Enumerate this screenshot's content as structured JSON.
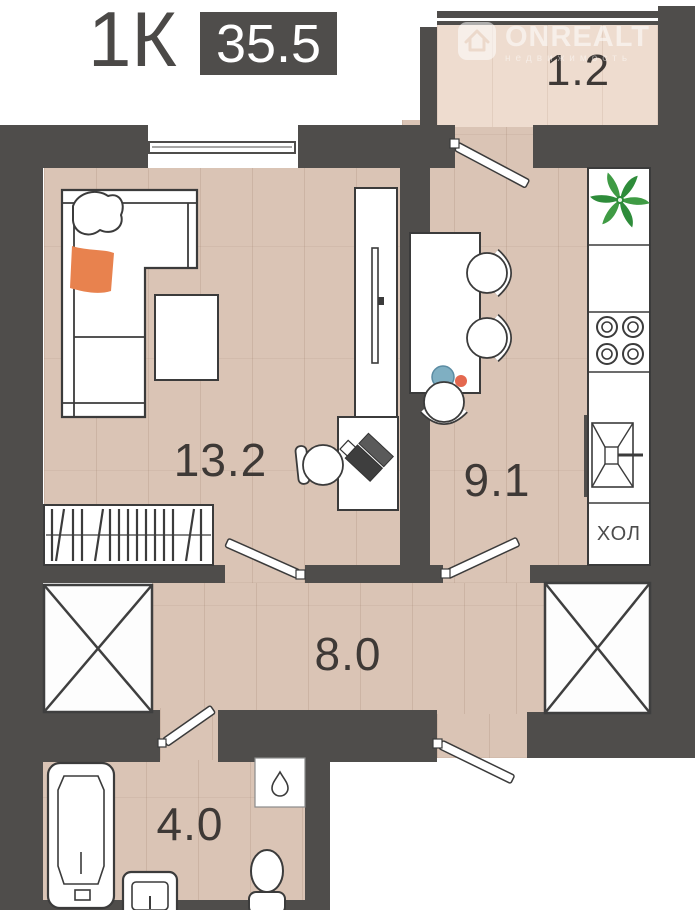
{
  "header": {
    "type_label": "1К",
    "area_value": "35.5"
  },
  "watermark": {
    "brand": "ONREALT",
    "tagline": "недвижимость"
  },
  "rooms": {
    "balcony": {
      "name": "balcony",
      "area": "1.2"
    },
    "living": {
      "name": "living-room",
      "area": "13.2"
    },
    "kitchen": {
      "name": "kitchen",
      "area": "9.1"
    },
    "hallway": {
      "name": "hallway",
      "area": "8.0"
    },
    "bathroom": {
      "name": "bathroom",
      "area": "4.0"
    }
  },
  "labels": {
    "fridge": "ХОЛ"
  },
  "colors": {
    "wall": "#4f4d4b",
    "floor": "#dac4b5",
    "balcony_floor": "#eedccf",
    "accent_orange": "#e8824e",
    "plant_green": "#3f9b44",
    "plant_green_dark": "#2e8c3a",
    "plate_blue": "#7fafc2",
    "tomato_red": "#e4684f"
  }
}
